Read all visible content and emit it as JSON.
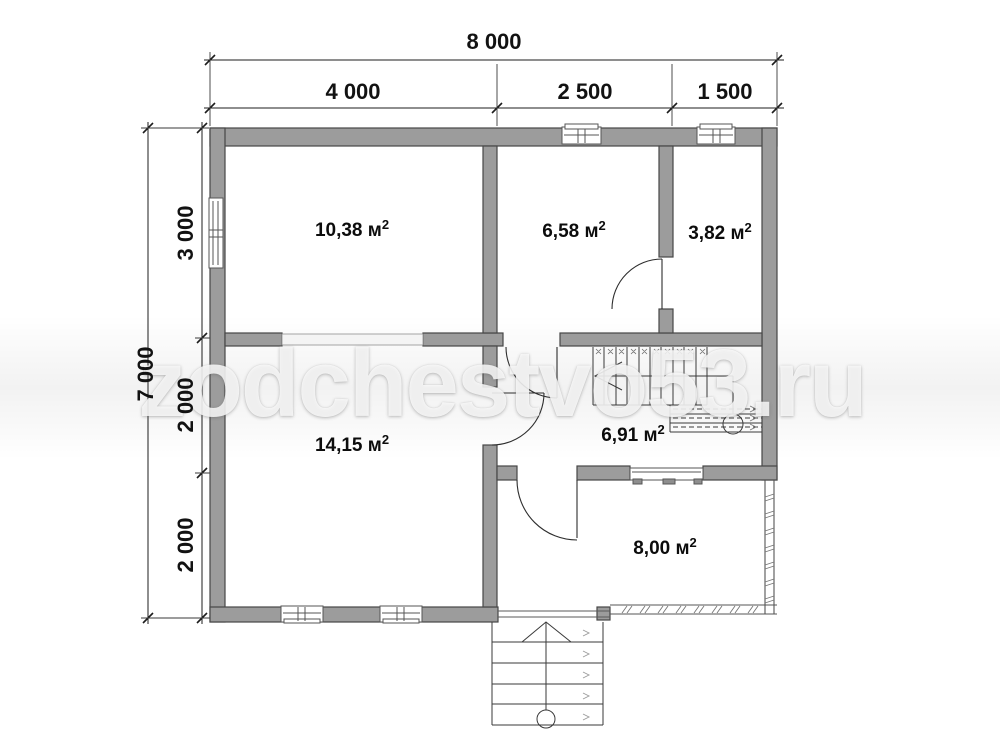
{
  "watermark": {
    "text": "zodchestvo53.ru"
  },
  "dimensions": {
    "top": {
      "overall": "8 000",
      "segments": [
        "4 000",
        "2 500",
        "1 500"
      ]
    },
    "left": {
      "overall": "7 000",
      "segments": [
        "3 000",
        "2 000",
        "2 000"
      ]
    }
  },
  "rooms": [
    {
      "label": "10,38 м",
      "sup": "2"
    },
    {
      "label": "6,58 м",
      "sup": "2"
    },
    {
      "label": "3,82 м",
      "sup": "2"
    },
    {
      "label": "14,15 м",
      "sup": "2"
    },
    {
      "label": "6,91 м",
      "sup": "2"
    },
    {
      "label": "8,00 м",
      "sup": "2"
    }
  ]
}
